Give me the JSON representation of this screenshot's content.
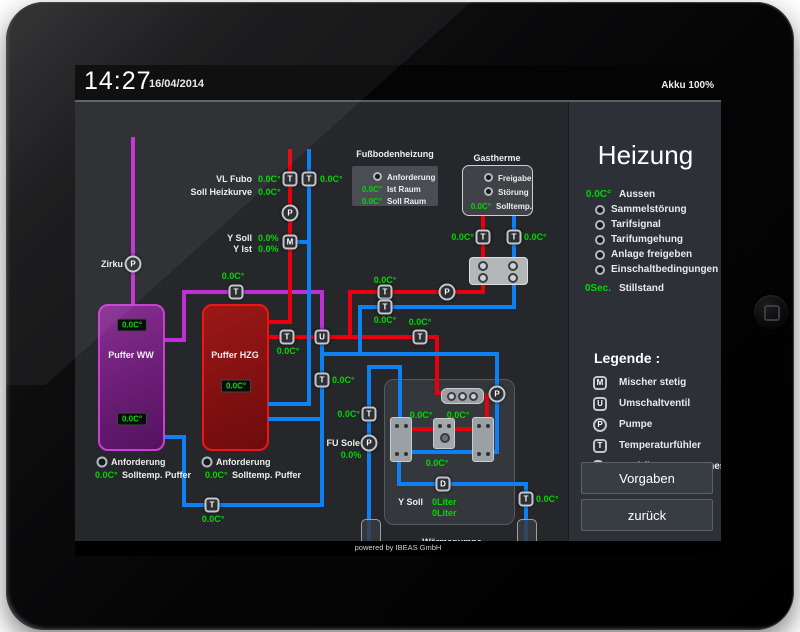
{
  "topbar": {
    "time": "14:27",
    "date": "16/04/2014",
    "battery": "Akku 100%"
  },
  "footer": {
    "text": "powered by IBEAS GmbH"
  },
  "sidebar": {
    "title": "Heizung",
    "status": [
      {
        "value": "0.0C°",
        "label": "Aussen"
      },
      {
        "led": true,
        "label": "Sammelstörung"
      },
      {
        "led": true,
        "label": "Tarifsignal"
      },
      {
        "led": true,
        "label": "Tarifumgehung"
      },
      {
        "led": true,
        "label": "Anlage freigeben"
      },
      {
        "led": true,
        "label": "Einschaltbedingungen"
      },
      {
        "value": "0Sec.",
        "label": "Stillstand",
        "gap": true
      }
    ],
    "legend_title": "Legende :",
    "legend": [
      {
        "symbol": "M",
        "shape": "square",
        "label": "Mischer stetig"
      },
      {
        "symbol": "U",
        "shape": "square",
        "label": "Umschaltventil"
      },
      {
        "symbol": "P",
        "shape": "circle",
        "label": "Pumpe"
      },
      {
        "symbol": "T",
        "shape": "square",
        "label": "Temperaturfühler"
      },
      {
        "symbol": "D",
        "shape": "square",
        "label": "Durchflussmengenmesser"
      }
    ],
    "buttons": [
      {
        "label": "Vorgaben"
      },
      {
        "label": "zurück"
      }
    ]
  },
  "panels": {
    "fussbodenheizung": {
      "rows": [
        {
          "led": true,
          "label": "Anforderung"
        },
        {
          "value": "0.0C°",
          "label": "Ist Raum"
        },
        {
          "value": "0.0C°",
          "label": "Soll Raum"
        }
      ]
    },
    "gastherme": {
      "rows": [
        {
          "led": true,
          "label": "Freigabe"
        },
        {
          "led": true,
          "label": "Störung"
        },
        {
          "value": "0.0C°",
          "label": "Solltemp."
        }
      ]
    }
  },
  "colors": {
    "pipe_red": "#e8000f",
    "pipe_blue": "#0e80f2",
    "pipe_purple": "#bf2fd6",
    "value_green": "#00d800"
  },
  "diagram": {
    "pipes": [
      {
        "n": "pipe-zirku",
        "c": "pp",
        "x": 56,
        "y": 35,
        "w": 4,
        "h": 167
      },
      {
        "n": "pipe-ww-out-h",
        "c": "pp",
        "x": 90,
        "y": 236,
        "w": 21,
        "h": 4
      },
      {
        "n": "pipe-ww-out-v",
        "c": "pp",
        "x": 107,
        "y": 188,
        "w": 4,
        "h": 52
      },
      {
        "n": "pipe-ww-main",
        "c": "pp",
        "x": 107,
        "y": 188,
        "w": 142,
        "h": 4
      },
      {
        "n": "pipe-ww-to-valve",
        "c": "pp",
        "x": 245,
        "y": 188,
        "w": 4,
        "h": 47
      },
      {
        "n": "pipe-supply-top",
        "c": "pr",
        "x": 213,
        "y": 47,
        "w": 4,
        "h": 173
      },
      {
        "n": "pipe-hzg-in",
        "c": "pr",
        "x": 193,
        "y": 218,
        "w": 24,
        "h": 4
      },
      {
        "n": "pipe-hzg-out",
        "c": "pr",
        "x": 193,
        "y": 233,
        "w": 171,
        "h": 4
      },
      {
        "n": "pipe-wp-supply",
        "c": "pr",
        "x": 360,
        "y": 233,
        "w": 4,
        "h": 60
      },
      {
        "n": "pipe-wp-supply-stub",
        "c": "pr",
        "x": 360,
        "y": 289,
        "w": 10,
        "h": 4
      },
      {
        "n": "pipe-gastherme-line",
        "c": "pr",
        "x": 273,
        "y": 188,
        "w": 137,
        "h": 4
      },
      {
        "n": "pipe-gastherme-junction",
        "c": "pr",
        "x": 273,
        "y": 188,
        "w": 4,
        "h": 49
      },
      {
        "n": "pipe-gastherme-down",
        "c": "pr",
        "x": 406,
        "y": 113,
        "w": 4,
        "h": 79
      },
      {
        "n": "pipe-compressor-out",
        "c": "pr",
        "x": 410,
        "y": 291,
        "w": 4,
        "h": 31
      },
      {
        "n": "pipe-wp-red",
        "c": "pr",
        "x": 334,
        "y": 325,
        "w": 80,
        "h": 4
      },
      {
        "n": "pipe-return-top",
        "c": "pb",
        "x": 232,
        "y": 47,
        "w": 4,
        "h": 257
      },
      {
        "n": "pipe-mixer-stub",
        "c": "pb",
        "x": 221,
        "y": 138,
        "w": 15,
        "h": 4
      },
      {
        "n": "pipe-hzg-return",
        "c": "pb",
        "x": 193,
        "y": 300,
        "w": 43,
        "h": 4
      },
      {
        "n": "pipe-gastherme-return-v",
        "c": "pb",
        "x": 437,
        "y": 113,
        "w": 4,
        "h": 94
      },
      {
        "n": "pipe-gastherme-return-h",
        "c": "pb",
        "x": 283,
        "y": 203,
        "w": 158,
        "h": 4
      },
      {
        "n": "pipe-gastherme-merge",
        "c": "pb",
        "x": 283,
        "y": 203,
        "w": 4,
        "h": 51
      },
      {
        "n": "pipe-wp-feed",
        "c": "pb",
        "x": 247,
        "y": 250,
        "w": 177,
        "h": 4
      },
      {
        "n": "pipe-valve-down",
        "c": "pb",
        "x": 245,
        "y": 233,
        "w": 4,
        "h": 172
      },
      {
        "n": "pipe-hzg-lower",
        "c": "pb",
        "x": 193,
        "y": 315,
        "w": 56,
        "h": 4
      },
      {
        "n": "pipe-bottom-return",
        "c": "pb",
        "x": 107,
        "y": 401,
        "w": 142,
        "h": 4
      },
      {
        "n": "pipe-ww-return-v",
        "c": "pb",
        "x": 107,
        "y": 333,
        "w": 4,
        "h": 72
      },
      {
        "n": "pipe-ww-return-h",
        "c": "pb",
        "x": 90,
        "y": 333,
        "w": 21,
        "h": 4
      },
      {
        "n": "pipe-wp-pump-v",
        "c": "pb",
        "x": 420,
        "y": 250,
        "w": 4,
        "h": 102
      },
      {
        "n": "pipe-wp-blue",
        "c": "pb",
        "x": 334,
        "y": 348,
        "w": 90,
        "h": 4
      },
      {
        "n": "pipe-sole-main",
        "c": "pb",
        "x": 292,
        "y": 263,
        "w": 4,
        "h": 192
      },
      {
        "n": "pipe-sole-top",
        "c": "pb",
        "x": 292,
        "y": 263,
        "w": 35,
        "h": 4
      },
      {
        "n": "pipe-evap-in",
        "c": "pb",
        "x": 323,
        "y": 263,
        "w": 4,
        "h": 57
      },
      {
        "n": "pipe-evap-out",
        "c": "pb",
        "x": 322,
        "y": 355,
        "w": 4,
        "h": 29
      },
      {
        "n": "pipe-sole-bottom",
        "c": "pb",
        "x": 322,
        "y": 380,
        "w": 131,
        "h": 4
      },
      {
        "n": "pipe-schluck",
        "c": "pb",
        "x": 449,
        "y": 382,
        "w": 4,
        "h": 73
      }
    ],
    "devices": [
      {
        "k": "T",
        "x": 215,
        "y": 77,
        "n": "temp-sensor-vl-fubo"
      },
      {
        "k": "T",
        "x": 234,
        "y": 77,
        "n": "temp-sensor-rl-fubo"
      },
      {
        "k": "T",
        "x": 161,
        "y": 190,
        "n": "temp-sensor-ww-line"
      },
      {
        "k": "T",
        "x": 212,
        "y": 235,
        "n": "temp-sensor-hzg-out"
      },
      {
        "k": "T",
        "x": 310,
        "y": 190,
        "n": "temp-sensor-gastherme-supply"
      },
      {
        "k": "T",
        "x": 310,
        "y": 205,
        "n": "temp-sensor-gastherme-return"
      },
      {
        "k": "T",
        "x": 345,
        "y": 235,
        "n": "temp-sensor-wp-supply"
      },
      {
        "k": "T",
        "x": 408,
        "y": 135,
        "n": "temp-sensor-gastherme-hot"
      },
      {
        "k": "T",
        "x": 439,
        "y": 135,
        "n": "temp-sensor-gastherme-cold"
      },
      {
        "k": "T",
        "x": 247,
        "y": 278,
        "n": "temp-sensor-valve-line"
      },
      {
        "k": "T",
        "x": 294,
        "y": 312,
        "n": "temp-sensor-sole"
      },
      {
        "k": "T",
        "x": 137,
        "y": 403,
        "n": "temp-sensor-bottom-return"
      },
      {
        "k": "T",
        "x": 451,
        "y": 397,
        "n": "temp-sensor-schluck"
      },
      {
        "k": "M",
        "x": 215,
        "y": 140,
        "n": "mixer"
      },
      {
        "k": "U",
        "x": 247,
        "y": 235,
        "n": "switch-valve"
      },
      {
        "k": "P",
        "x": 215,
        "y": 111,
        "n": "pump-heating-circuit"
      },
      {
        "k": "P",
        "x": 58,
        "y": 162,
        "n": "pump-zirku"
      },
      {
        "k": "P",
        "x": 372,
        "y": 190,
        "n": "pump-gastherme"
      },
      {
        "k": "P",
        "x": 422,
        "y": 292,
        "n": "pump-waermepumpe"
      },
      {
        "k": "P",
        "x": 294,
        "y": 341,
        "n": "pump-fu-sole"
      },
      {
        "k": "D",
        "x": 368,
        "y": 382,
        "n": "flow-meter"
      },
      {
        "k": "L",
        "x": 27,
        "y": 360,
        "n": "indicator-anforderung-ww"
      },
      {
        "k": "L",
        "x": 132,
        "y": 360,
        "n": "indicator-anforderung-hzg"
      }
    ],
    "labels": [
      {
        "t": "VL Fubo",
        "x": 177,
        "y": 77,
        "a": "r",
        "n": "label-vl-fubo"
      },
      {
        "t": "0.0C°",
        "x": 183,
        "y": 77,
        "c": "g",
        "n": "value-vl-fubo"
      },
      {
        "t": "0.0C°",
        "x": 245,
        "y": 77,
        "c": "g",
        "n": "value-rl-fubo"
      },
      {
        "t": "Soll Heizkurve",
        "x": 177,
        "y": 90,
        "a": "r",
        "n": "label-soll-heizkurve"
      },
      {
        "t": "0.0C°",
        "x": 183,
        "y": 90,
        "c": "g",
        "n": "value-soll-heizkurve"
      },
      {
        "t": "Y Soll",
        "x": 177,
        "y": 136,
        "a": "r",
        "n": "label-y-soll-mixer"
      },
      {
        "t": "0.0%",
        "x": 183,
        "y": 136,
        "c": "g",
        "n": "value-y-soll-mixer"
      },
      {
        "t": "Y Ist",
        "x": 177,
        "y": 147,
        "a": "r",
        "n": "label-y-ist-mixer"
      },
      {
        "t": "0.0%",
        "x": 183,
        "y": 147,
        "c": "g",
        "n": "value-y-ist-mixer"
      },
      {
        "t": "Zirku",
        "x": 48,
        "y": 162,
        "a": "r",
        "n": "label-zirku"
      },
      {
        "t": "0.0C°",
        "x": 158,
        "y": 174,
        "a": "c",
        "c": "g",
        "n": "value-ww-line"
      },
      {
        "t": "0.0C°",
        "x": 310,
        "y": 178,
        "a": "c",
        "c": "g",
        "n": "value-gastherme-supply"
      },
      {
        "t": "0.0C°",
        "x": 310,
        "y": 218,
        "a": "c",
        "c": "g",
        "n": "value-gastherme-return"
      },
      {
        "t": "0.0C°",
        "x": 213,
        "y": 249,
        "a": "c",
        "c": "g",
        "n": "value-hzg-out"
      },
      {
        "t": "0.0C°",
        "x": 345,
        "y": 220,
        "a": "c",
        "c": "g",
        "n": "value-wp-supply"
      },
      {
        "t": "0.0C°",
        "x": 399,
        "y": 135,
        "a": "r",
        "c": "g",
        "n": "value-gastherme-hot"
      },
      {
        "t": "0.0C°",
        "x": 449,
        "y": 135,
        "c": "g",
        "n": "value-gastherme-cold"
      },
      {
        "t": "0.0C°",
        "x": 257,
        "y": 278,
        "c": "g",
        "n": "value-valve-line"
      },
      {
        "t": "0.0C°",
        "x": 285,
        "y": 312,
        "a": "r",
        "c": "g",
        "n": "value-sole"
      },
      {
        "t": "FU Sole",
        "x": 285,
        "y": 341,
        "a": "r",
        "n": "label-fu-sole"
      },
      {
        "t": "0.0%",
        "x": 276,
        "y": 353,
        "a": "c",
        "c": "g",
        "n": "value-fu-sole"
      },
      {
        "t": "0.0C°",
        "x": 461,
        "y": 397,
        "c": "g",
        "n": "value-schluck"
      },
      {
        "t": "0.0C°",
        "x": 346,
        "y": 313,
        "a": "c",
        "c": "g",
        "n": "value-wp-hot-1"
      },
      {
        "t": "0.0C°",
        "x": 383,
        "y": 313,
        "a": "c",
        "c": "g",
        "n": "value-wp-hot-2"
      },
      {
        "t": "0.0C°",
        "x": 362,
        "y": 361,
        "a": "c",
        "c": "g",
        "n": "value-wp-cold"
      },
      {
        "t": "Y Soll",
        "x": 348,
        "y": 400,
        "a": "r",
        "n": "label-y-soll-wp"
      },
      {
        "t": "0Liter",
        "x": 357,
        "y": 400,
        "c": "g",
        "n": "value-y-soll-liter-1"
      },
      {
        "t": "0Liter",
        "x": 357,
        "y": 411,
        "c": "g",
        "n": "value-y-soll-liter-2"
      },
      {
        "t": "Wärmepumpe",
        "x": 377,
        "y": 440,
        "a": "c",
        "n": "label-waermepumpe"
      },
      {
        "t": "Saug",
        "x": 296,
        "y": 471,
        "a": "c",
        "n": "label-saug"
      },
      {
        "t": "Schluck",
        "x": 452,
        "y": 471,
        "a": "c",
        "n": "label-schluck"
      },
      {
        "t": "Puffer WW",
        "x": 56,
        "y": 253,
        "a": "c",
        "n": "label-puffer-ww"
      },
      {
        "t": "Puffer HZG",
        "x": 160,
        "y": 253,
        "a": "c",
        "n": "label-puffer-hzg"
      },
      {
        "t": "Anforderung",
        "x": 36,
        "y": 360,
        "n": "label-anforderung-ww"
      },
      {
        "t": "0.0C°",
        "x": 20,
        "y": 373,
        "c": "g",
        "n": "value-solltemp-ww"
      },
      {
        "t": "Solltemp. Puffer",
        "x": 47,
        "y": 373,
        "n": "label-solltemp-ww"
      },
      {
        "t": "Anforderung",
        "x": 141,
        "y": 360,
        "n": "label-anforderung-hzg"
      },
      {
        "t": "0.0C°",
        "x": 130,
        "y": 373,
        "c": "g",
        "n": "value-solltemp-hzg"
      },
      {
        "t": "Solltemp. Puffer",
        "x": 157,
        "y": 373,
        "n": "label-solltemp-hzg"
      },
      {
        "t": "0.0C°",
        "x": 138,
        "y": 417,
        "a": "c",
        "c": "g",
        "n": "value-bottom-return"
      },
      {
        "t": "Fußbodenheizung",
        "x": 320,
        "y": 52,
        "a": "c",
        "n": "panel-title-fussbodenheizung"
      },
      {
        "t": "Gastherme",
        "x": 422,
        "y": 56,
        "a": "c",
        "n": "panel-title-gastherme"
      }
    ],
    "displays": [
      {
        "t": "0.0C°",
        "x": 57,
        "y": 223,
        "n": "display-ww-top"
      },
      {
        "t": "0.0C°",
        "x": 57,
        "y": 317,
        "n": "display-ww-bottom"
      },
      {
        "t": "0.0C°",
        "x": 161,
        "y": 284,
        "n": "display-hzg"
      }
    ]
  }
}
